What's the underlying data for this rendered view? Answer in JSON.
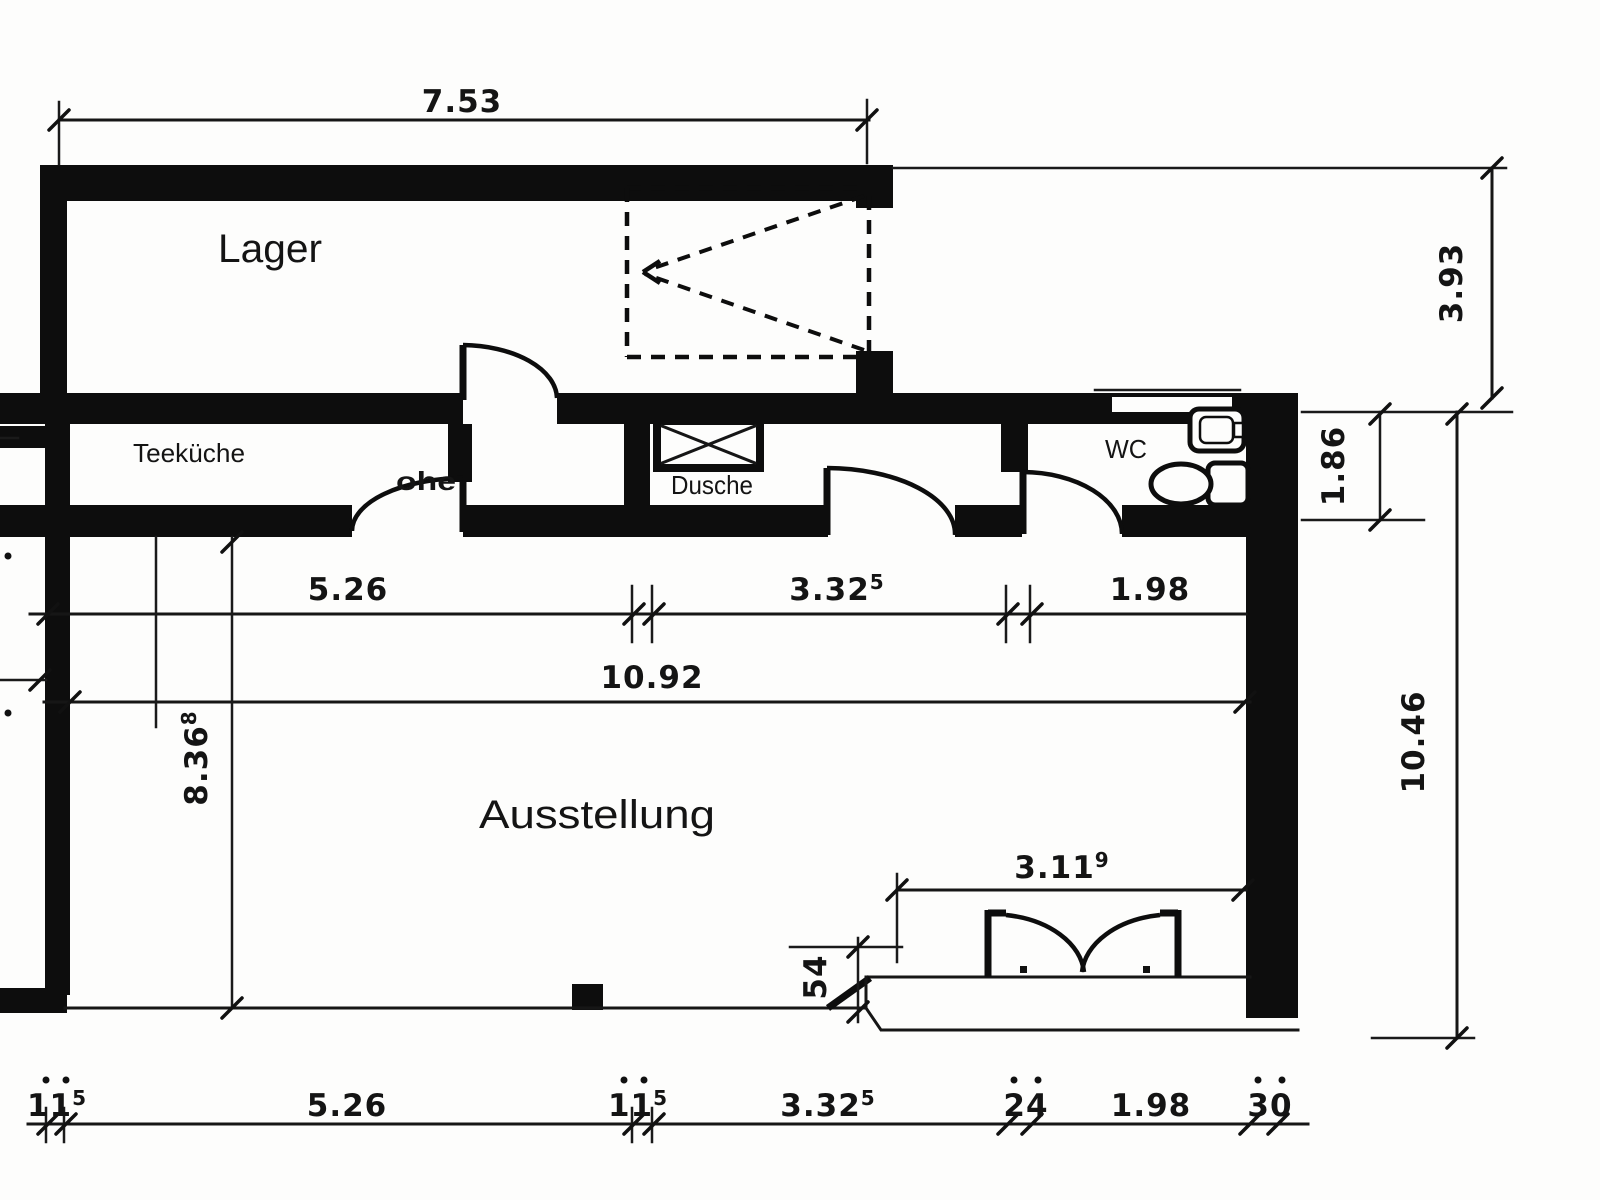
{
  "rooms": {
    "lager": {
      "label": "Lager"
    },
    "teekueche": {
      "label": "Teeküche"
    },
    "dusche": {
      "label": "Dusche"
    },
    "wc": {
      "label": "WC"
    },
    "ausstellung": {
      "label": "Ausstellung"
    },
    "fragment": {
      "label": "ohe"
    }
  },
  "dims": {
    "top_width": {
      "value": "7.53"
    },
    "right_depth": {
      "value": "3.93"
    },
    "strip_height": {
      "value": "1.86"
    },
    "right_total": {
      "value": "10.46"
    },
    "row_a": [
      {
        "value": "5.26"
      },
      {
        "value": "3.32",
        "sup": "5"
      },
      {
        "value": "1.98"
      }
    ],
    "row_total": {
      "value": "10.92"
    },
    "room_height": {
      "value": "8.36",
      "sup": "8"
    },
    "entrance_width": {
      "value": "3.11",
      "sup": "9"
    },
    "step": {
      "value": "54"
    },
    "bottom_row": [
      {
        "value": "11",
        "sup": "5"
      },
      {
        "value": "5.26"
      },
      {
        "value": "11",
        "sup": "5"
      },
      {
        "value": "3.32",
        "sup": "5"
      },
      {
        "value": "24"
      },
      {
        "value": "1.98"
      },
      {
        "value": "30"
      }
    ]
  }
}
